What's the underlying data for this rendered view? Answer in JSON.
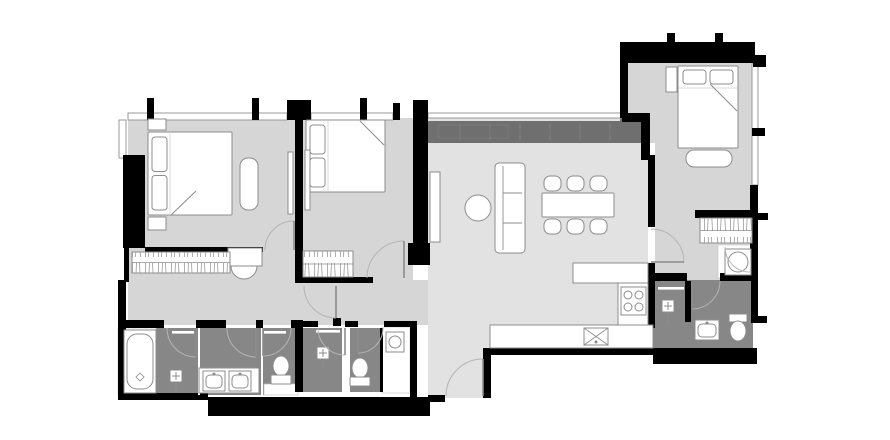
{
  "canvas": {
    "width": 890,
    "height": 440,
    "background": "#ffffff"
  },
  "palette": {
    "wall": "#000000",
    "floor": "#d6d6d6",
    "floor2": "#e2e2e2",
    "wet": "#878787",
    "band": "#6f6f6f",
    "fixture": "#ffffff",
    "stroke": "#8c8c8c",
    "window_stroke": "#9a9a9a",
    "door_arc": "#b4b4b4"
  },
  "floors": [
    {
      "name": "floor-bedroom-1",
      "rect": [
        128,
        118,
        167,
        134
      ],
      "fill": "floor"
    },
    {
      "name": "floor-corridor-west",
      "rect": [
        128,
        248,
        175,
        77
      ],
      "fill": "floor"
    },
    {
      "name": "floor-bedroom-2",
      "rect": [
        303,
        118,
        110,
        162
      ],
      "fill": "floor"
    },
    {
      "name": "floor-corridor-center",
      "rect": [
        303,
        280,
        127,
        45
      ],
      "fill": "floor"
    },
    {
      "name": "floor-living-dining",
      "poly": [
        [
          428,
          118
        ],
        [
          648,
          118
        ],
        [
          648,
          348
        ],
        [
          483,
          348
        ],
        [
          483,
          398
        ],
        [
          428,
          398
        ]
      ],
      "fill": "floor2"
    },
    {
      "name": "floor-bedroom-3-hall",
      "poly": [
        [
          628,
          62
        ],
        [
          753,
          62
        ],
        [
          753,
          280
        ],
        [
          655,
          280
        ],
        [
          655,
          143
        ],
        [
          628,
          143
        ]
      ],
      "fill": "floor"
    }
  ],
  "wet_floors": [
    {
      "name": "floor-master-bathroom",
      "rect": [
        156,
        328,
        142,
        67
      ]
    },
    {
      "name": "floor-bathroom-2",
      "rect": [
        303,
        328,
        39,
        64
      ]
    },
    {
      "name": "floor-wc-2",
      "rect": [
        350,
        328,
        32,
        64
      ]
    },
    {
      "name": "floor-bathroom-3",
      "rect": [
        648,
        280,
        105,
        68
      ]
    }
  ],
  "underlays": [
    {
      "name": "bathtub-zone",
      "rect": [
        118,
        328,
        38,
        67
      ]
    },
    {
      "name": "laundry-room",
      "rect": [
        382,
        327,
        28,
        66
      ]
    },
    {
      "name": "toilet-nook",
      "rect": [
        264,
        384,
        34,
        11
      ]
    },
    {
      "name": "closet",
      "rect": [
        718,
        245,
        34,
        33
      ]
    }
  ],
  "kitchen_band": {
    "rect": [
      428,
      121,
      220,
      22
    ],
    "ext": [
      620,
      115,
      28,
      28
    ],
    "lines_x": [
      460,
      490,
      520,
      550,
      580,
      610
    ],
    "detail_rect": [
      438,
      125,
      70,
      13
    ]
  },
  "walls": [
    [
      147,
      98,
      7,
      22
    ],
    [
      252,
      98,
      7,
      22
    ],
    [
      360,
      98,
      7,
      22
    ],
    [
      287,
      100,
      24,
      20
    ],
    [
      393,
      103,
      7,
      17
    ],
    [
      413,
      100,
      15,
      150
    ],
    [
      408,
      243,
      22,
      22
    ],
    [
      622,
      113,
      28,
      9
    ],
    [
      641,
      122,
      9,
      38
    ],
    [
      620,
      42,
      8,
      76
    ],
    [
      623,
      42,
      132,
      21
    ],
    [
      667,
      33,
      8,
      9
    ],
    [
      715,
      33,
      8,
      9
    ],
    [
      753,
      55,
      13,
      12
    ],
    [
      752,
      128,
      13,
      8
    ],
    [
      750,
      185,
      8,
      96
    ],
    [
      753,
      213,
      15,
      7
    ],
    [
      695,
      210,
      58,
      8
    ],
    [
      648,
      155,
      7,
      72
    ],
    [
      648,
      263,
      7,
      65
    ],
    [
      640,
      273,
      47,
      8
    ],
    [
      720,
      273,
      33,
      8
    ],
    [
      685,
      281,
      6,
      41
    ],
    [
      653,
      348,
      104,
      16
    ],
    [
      751,
      281,
      7,
      42
    ],
    [
      751,
      316,
      16,
      7
    ],
    [
      483,
      348,
      172,
      7
    ],
    [
      483,
      350,
      8,
      48
    ],
    [
      428,
      395,
      17,
      7
    ],
    [
      208,
      397,
      222,
      19
    ],
    [
      118,
      393,
      90,
      7
    ],
    [
      118,
      280,
      8,
      120
    ],
    [
      124,
      248,
      5,
      34
    ],
    [
      123,
      155,
      22,
      93
    ],
    [
      145,
      247,
      118,
      5
    ],
    [
      295,
      118,
      8,
      165
    ],
    [
      295,
      277,
      78,
      6
    ],
    [
      118,
      320,
      46,
      8
    ],
    [
      196,
      320,
      30,
      8
    ],
    [
      256,
      320,
      7,
      8
    ],
    [
      291,
      320,
      12,
      8
    ],
    [
      295,
      321,
      8,
      71
    ],
    [
      333,
      318,
      8,
      8
    ],
    [
      303,
      321,
      15,
      6
    ],
    [
      345,
      321,
      13,
      6
    ],
    [
      384,
      321,
      26,
      6
    ],
    [
      410,
      321,
      7,
      76
    ],
    [
      380,
      328,
      3,
      64
    ]
  ],
  "windows": [
    [
      128,
      113,
      159,
      7
    ],
    [
      311,
      113,
      82,
      7
    ],
    [
      428,
      113,
      194,
      5
    ],
    [
      119,
      120,
      7,
      38
    ],
    [
      752,
      63,
      6,
      122
    ]
  ],
  "white_dividers": [
    [
      198,
      328,
      2,
      67
    ],
    [
      261,
      328,
      2,
      67
    ]
  ],
  "furniture": [
    {
      "type": "bed",
      "name": "bed-master",
      "x": 148,
      "y": 132,
      "w": 84,
      "h": 83,
      "head": "left",
      "fold": [
        171,
        215,
        196,
        191
      ]
    },
    {
      "type": "bed",
      "name": "bed-2",
      "x": 306,
      "y": 120,
      "w": 79,
      "h": 72,
      "head": "left",
      "fold": [
        360,
        121,
        384,
        145
      ]
    },
    {
      "type": "bed",
      "name": "bed-3",
      "x": 678,
      "y": 66,
      "w": 60,
      "h": 82,
      "head": "top",
      "fold": [
        710,
        84,
        737,
        111
      ]
    },
    {
      "type": "panel",
      "name": "nightstand",
      "x": 148,
      "y": 119,
      "w": 18,
      "h": 11
    },
    {
      "type": "panel",
      "name": "nightstand",
      "x": 148,
      "y": 217,
      "w": 18,
      "h": 13
    },
    {
      "type": "panel",
      "name": "nightstand",
      "x": 666,
      "y": 67,
      "w": 11,
      "h": 25
    },
    {
      "type": "bench",
      "name": "bench",
      "x": 240,
      "y": 158,
      "w": 18,
      "h": 52
    },
    {
      "type": "bench",
      "name": "bench",
      "x": 686,
      "y": 150,
      "w": 46,
      "h": 17
    },
    {
      "type": "panel",
      "name": "tv-panel",
      "x": 288,
      "y": 152,
      "w": 5,
      "h": 62
    },
    {
      "type": "panel",
      "name": "tv-panel",
      "x": 305,
      "y": 150,
      "w": 5,
      "h": 60
    },
    {
      "type": "panel",
      "name": "tv-cabinet",
      "x": 430,
      "y": 172,
      "w": 10,
      "h": 70
    },
    {
      "type": "sofa",
      "name": "sofa",
      "x": 495,
      "y": 163,
      "w": 30,
      "h": 90
    },
    {
      "type": "round_table",
      "name": "coffee-table",
      "cx": 478,
      "cy": 208,
      "r": 13
    },
    {
      "type": "dining",
      "name": "dining-table",
      "x": 542,
      "y": 193,
      "w": 72,
      "h": 24
    },
    {
      "type": "counter",
      "name": "kitchen-counter",
      "x": 573,
      "y": 263,
      "w": 75,
      "h": 20
    },
    {
      "type": "counter",
      "name": "kitchen-counter",
      "x": 618,
      "y": 283,
      "w": 30,
      "h": 42
    },
    {
      "type": "counter",
      "name": "kitchen-counter",
      "x": 490,
      "y": 325,
      "w": 163,
      "h": 23
    },
    {
      "type": "stove",
      "name": "stove",
      "x": 621,
      "y": 287,
      "w": 25,
      "h": 28
    },
    {
      "type": "ksink",
      "name": "kitchen-sink",
      "x": 584,
      "y": 328,
      "w": 24,
      "h": 17
    },
    {
      "type": "tub",
      "name": "bathtub",
      "x": 124,
      "y": 330,
      "w": 32,
      "h": 63
    },
    {
      "type": "counter",
      "name": "vanity-counter",
      "x": 199,
      "y": 368,
      "w": 60,
      "h": 25
    },
    {
      "type": "sink",
      "name": "sink",
      "x": 203,
      "y": 371,
      "w": 22,
      "h": 20
    },
    {
      "type": "sink",
      "name": "sink",
      "x": 229,
      "y": 371,
      "w": 22,
      "h": 20
    },
    {
      "type": "sink",
      "name": "sink",
      "x": 695,
      "y": 320,
      "w": 24,
      "h": 20
    },
    {
      "type": "shower",
      "name": "shower-fixture",
      "x": 170,
      "y": 370
    },
    {
      "type": "shower",
      "name": "shower-fixture",
      "x": 317,
      "y": 347
    },
    {
      "type": "shower",
      "name": "shower-fixture",
      "x": 662,
      "y": 300
    },
    {
      "type": "towel",
      "name": "towel-bar",
      "x": 172,
      "y": 331,
      "len": 22
    },
    {
      "type": "towel",
      "name": "towel-bar",
      "x": 264,
      "y": 331,
      "len": 22
    },
    {
      "type": "towel",
      "name": "towel-bar",
      "x": 316,
      "y": 330,
      "len": 24
    },
    {
      "type": "towel",
      "name": "towel-bar",
      "x": 658,
      "y": 287,
      "len": 26
    },
    {
      "type": "toilet",
      "name": "toilet",
      "cx": 281,
      "cy": 366,
      "dir": "down"
    },
    {
      "type": "toilet",
      "name": "toilet",
      "cx": 360,
      "cy": 368,
      "dir": "down"
    },
    {
      "type": "toilet",
      "name": "toilet",
      "cx": 738,
      "cy": 328,
      "dir": "up"
    },
    {
      "type": "washer",
      "name": "washing-machine",
      "x": 386,
      "y": 332,
      "w": 18,
      "h": 20
    },
    {
      "type": "washer",
      "name": "closet-basin",
      "x": 725,
      "y": 249,
      "w": 26,
      "h": 26
    },
    {
      "type": "counter",
      "name": "dressing-table",
      "x": 228,
      "y": 248,
      "w": 34,
      "h": 18
    },
    {
      "type": "stool",
      "name": "stool",
      "cx": 244,
      "cy": 266,
      "r": 13
    },
    {
      "type": "wardrobe",
      "name": "wardrobe",
      "x": 132,
      "y": 252,
      "w": 98,
      "h": 21
    },
    {
      "type": "wardrobe",
      "name": "wardrobe",
      "x": 303,
      "y": 251,
      "w": 50,
      "h": 26
    },
    {
      "type": "wardrobe",
      "name": "wardrobe",
      "x": 700,
      "y": 218,
      "w": 52,
      "h": 25
    }
  ],
  "doors": [
    {
      "name": "door-bedroom-1",
      "pivot": [
        294,
        250
      ],
      "r": 29,
      "from": 180,
      "to": 270,
      "leaf": 270
    },
    {
      "name": "door-bedroom-2",
      "pivot": [
        404,
        278
      ],
      "r": 37,
      "from": 270,
      "to": 180,
      "leaf": 270
    },
    {
      "name": "door-corridor",
      "pivot": [
        336,
        286
      ],
      "r": 32,
      "from": 180,
      "to": 90,
      "leaf": 90
    },
    {
      "name": "door-hall",
      "pivot": [
        651,
        262
      ],
      "r": 33,
      "from": 270,
      "to": 0,
      "leaf": 0
    },
    {
      "name": "door-entry",
      "pivot": [
        483,
        396
      ],
      "r": 37,
      "from": 180,
      "to": 270,
      "leaf": 270
    },
    {
      "name": "door-bathroom-3",
      "pivot": [
        692,
        281
      ],
      "r": 28,
      "from": 90,
      "to": 0,
      "leaf": 90
    },
    {
      "name": "door-master-bath-1",
      "pivot": [
        196,
        328
      ],
      "r": 29,
      "from": 90,
      "to": 180,
      "leaf": 90
    },
    {
      "name": "door-master-bath-2",
      "pivot": [
        256,
        328
      ],
      "r": 29,
      "from": 90,
      "to": 180,
      "leaf": 90
    },
    {
      "name": "door-wc-1",
      "pivot": [
        263,
        328
      ],
      "r": 28,
      "from": 90,
      "to": 0,
      "leaf": 90
    },
    {
      "name": "door-bath-2",
      "pivot": [
        345,
        328
      ],
      "r": 27,
      "from": 90,
      "to": 180,
      "leaf": 90
    },
    {
      "name": "door-wc-2",
      "pivot": [
        358,
        328
      ],
      "r": 25,
      "from": 90,
      "to": 0,
      "leaf": 90
    },
    {
      "name": "door-closet",
      "pivot": [
        750,
        247
      ],
      "r": 25,
      "from": 180,
      "to": 90,
      "leaf": false
    }
  ]
}
